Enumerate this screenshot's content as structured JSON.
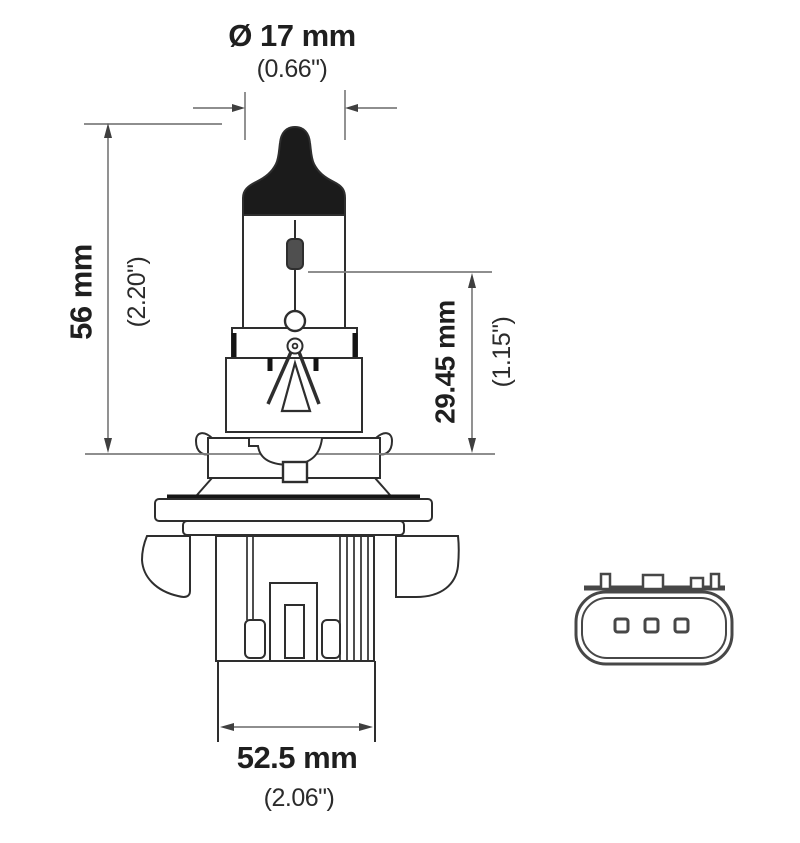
{
  "colors": {
    "ink": "#2e2e2e",
    "black_fill": "#1b1b1b",
    "filament_fill": "#4f4f4f",
    "dimension_line": "#7e7e7e",
    "arrow": "#3f3f3f",
    "connector_ink": "#474747",
    "background": "#ffffff"
  },
  "dimensions": {
    "tip_diameter": {
      "metric": "Ø 17 mm",
      "imperial": "(0.66\")"
    },
    "overall_height": {
      "metric": "56 mm",
      "imperial": "(2.20\")"
    },
    "light_center_length": {
      "metric": "29.45 mm",
      "imperial": "(1.15\")"
    },
    "base_width": {
      "metric": "52.5 mm",
      "imperial": "(2.06\")"
    }
  },
  "connector": {
    "pin_count": 3
  }
}
